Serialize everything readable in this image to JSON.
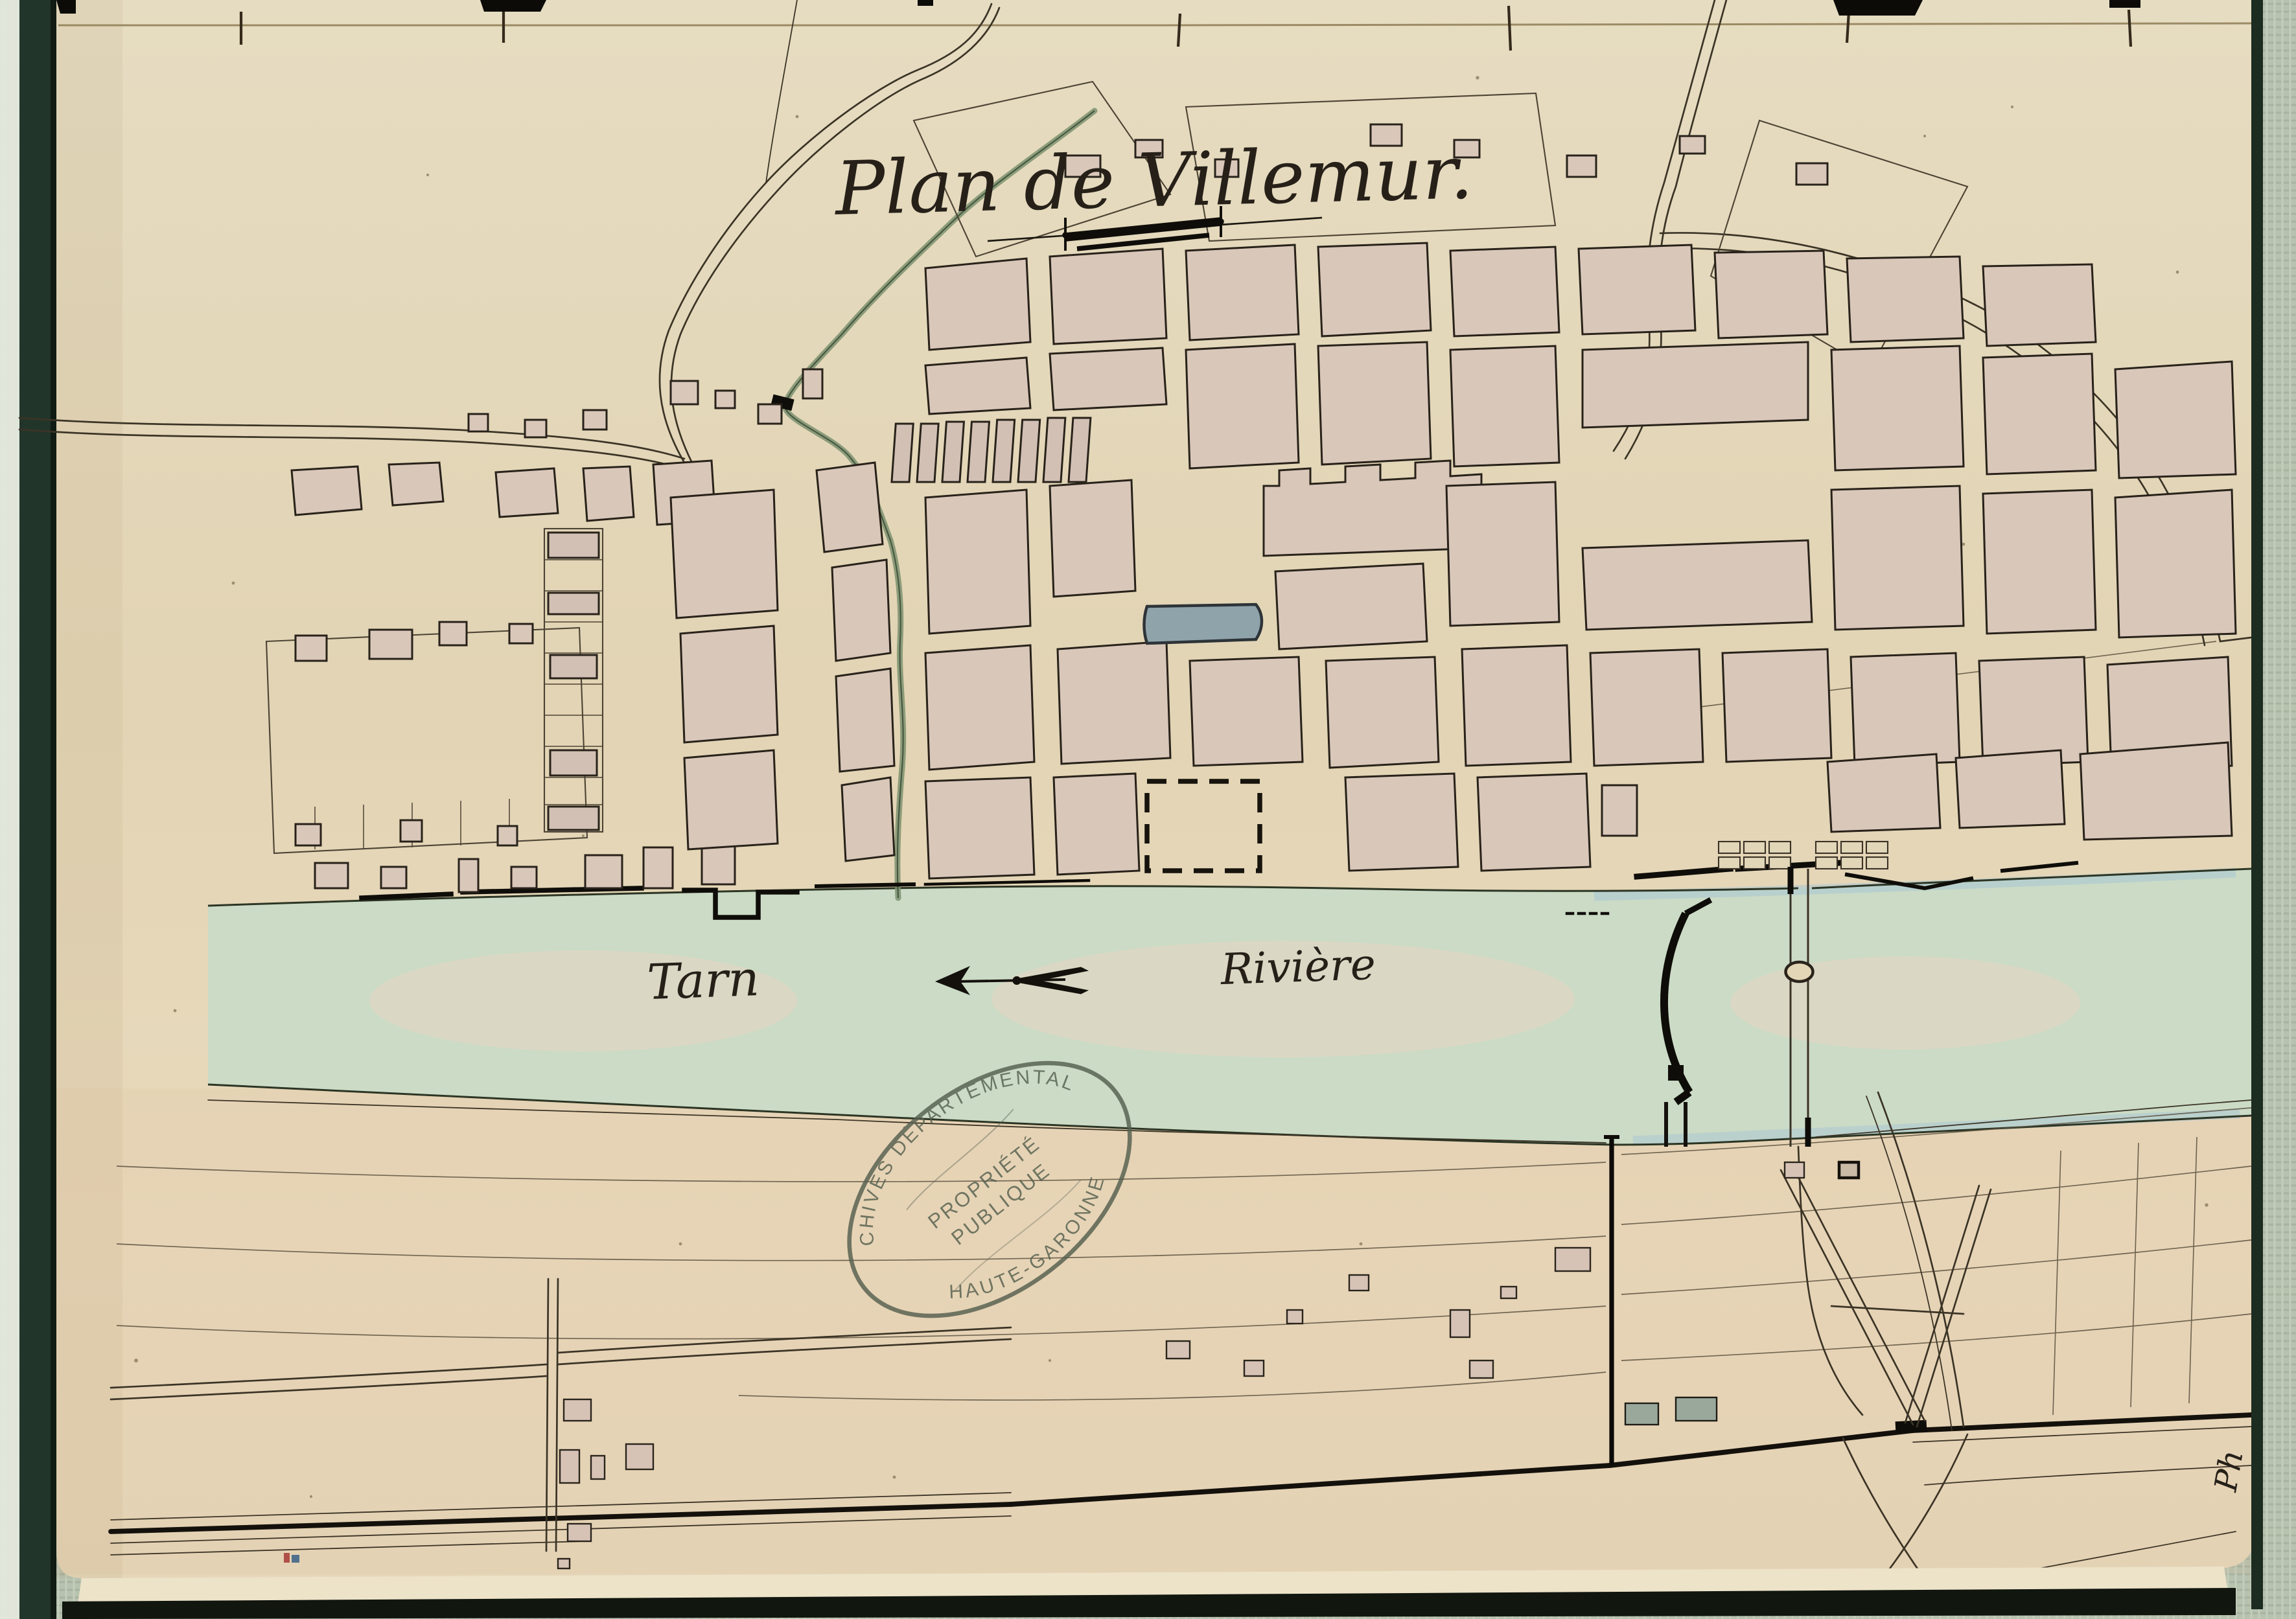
{
  "document": {
    "title": "Plan de Villemur.",
    "corner_mark": "Ph"
  },
  "map_labels": {
    "river_name": "Tarn",
    "river_word": "Rivière"
  },
  "stamp": {
    "arc_top": "ARCHIVES DÉPARTEMENTALES",
    "arc_bottom": "HAUTE-GARONNE",
    "center_line1": "PROPRIÉTÉ",
    "center_line2": "PUBLIQUE"
  },
  "icons": {
    "flow_arrow": "left-arrow",
    "scale_ornament": "drafting-scale-bar"
  },
  "colors": {
    "paper": "#e4d7b8",
    "river_green": "#cbdbc6",
    "water_blue": "#a9c6d4",
    "block_pink": "#d9c7b9",
    "ink": "#28221a",
    "stamp_green": "#55604f",
    "binding_green": "#22352a",
    "fabric_green": "#b7c2af",
    "feature_blue": "#8fa3ab",
    "teal_block": "#9aa89b"
  }
}
